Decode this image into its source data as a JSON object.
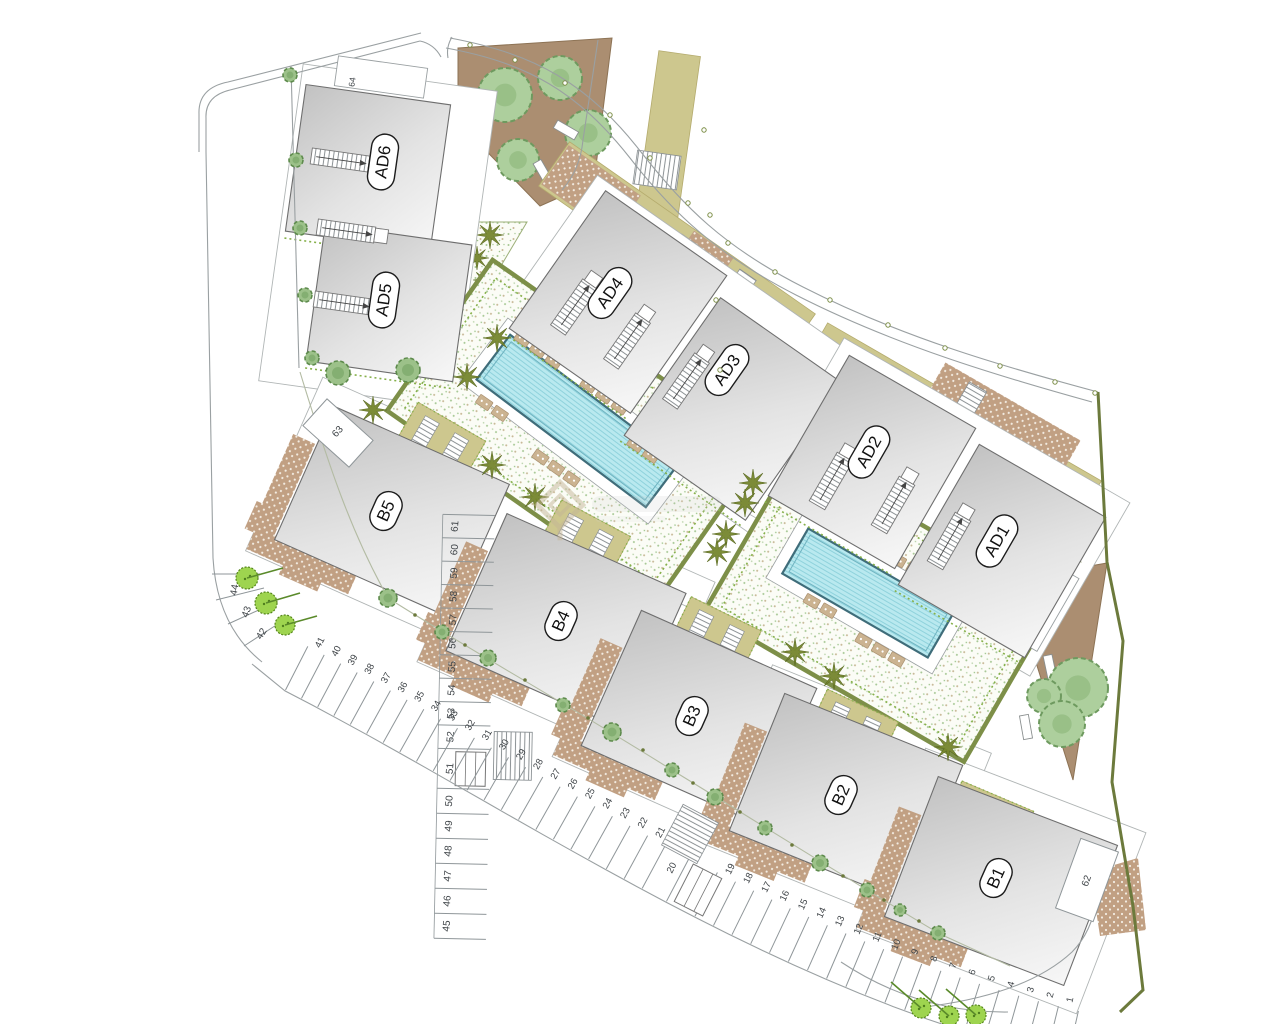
{
  "plan": {
    "type": "residential-site-plan",
    "buildings": {
      "labels": [
        "AD6",
        "AD5",
        "AD4",
        "AD3",
        "AD2",
        "AD1",
        "B5",
        "B4",
        "B3",
        "B2",
        "B1"
      ]
    },
    "parking": {
      "left_numbers": [
        "61",
        "60",
        "59",
        "58",
        "57",
        "56",
        "55",
        "54",
        "53",
        "52",
        "51",
        "50",
        "49",
        "48",
        "47",
        "46",
        "45"
      ],
      "curve_numbers": [
        "44",
        "43",
        "42"
      ],
      "row_numbers": [
        "41",
        "40",
        "39",
        "38",
        "37",
        "36",
        "35",
        "34",
        "33",
        "32",
        "31",
        "30",
        "29",
        "28",
        "27",
        "26",
        "25",
        "24",
        "23",
        "22",
        "21",
        "20",
        "19",
        "18",
        "17",
        "16",
        "15",
        "14",
        "13",
        "12",
        "11",
        "10",
        "9",
        "8",
        "7",
        "6",
        "5",
        "4",
        "3",
        "2",
        "1"
      ],
      "special_numbers": [
        "62",
        "63",
        "64"
      ],
      "accessible_spaces": [
        "51",
        "20"
      ]
    },
    "features": {
      "pools": [
        "pool-1",
        "pool-2"
      ],
      "courtyards": [
        "courtyard-1",
        "courtyard-2"
      ],
      "gardens": [
        "garden-top-right",
        "garden-right-triangle",
        "garden-palm-triangle"
      ]
    },
    "colors": {
      "building_gray": "#e0e0e0",
      "pool_cyan": "#b9e9ef",
      "olive_strip": "#cdc78e",
      "courtyard_border": "#7d8f48",
      "garden_brown": "#ab8e71",
      "patio_brown": "#c1a083",
      "tree_green": "#9cc189",
      "bush_green": "#9ed44f",
      "boundary_olive": "#6c7a3c",
      "line_gray": "#9aa0a2"
    },
    "watermark": {
      "icon": "diamond-logo"
    }
  }
}
